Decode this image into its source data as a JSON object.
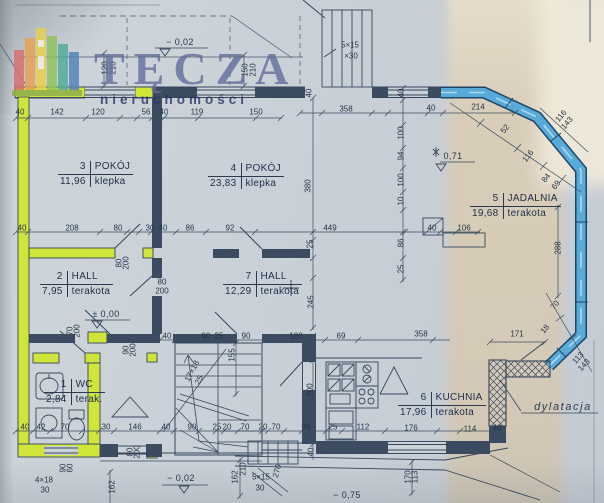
{
  "watermark": {
    "brand": "TĘCZA",
    "subtitle": "nieruchomości"
  },
  "colors": {
    "highlight_green": "#cfe53a",
    "highlight_blue": "#58aad8",
    "line": "#36465c",
    "paper": "#cbd2d8",
    "paper_tan": "#d9cdb7"
  },
  "rooms": [
    {
      "number": "3",
      "name": "POKÓJ",
      "area": "11,96",
      "floor": "klepka"
    },
    {
      "number": "4",
      "name": "POKÓJ",
      "area": "23,83",
      "floor": "klepka"
    },
    {
      "number": "5",
      "name": "JADALNIA",
      "area": "19,68",
      "floor": "terakota"
    },
    {
      "number": "2",
      "name": "HALL",
      "area": "7,95",
      "floor": "terakota"
    },
    {
      "number": "7",
      "name": "HALL",
      "area": "12,29",
      "floor": "terakota"
    },
    {
      "number": "1",
      "name": "WC",
      "area": "2,84",
      "floor": "terak."
    },
    {
      "number": "6",
      "name": "KUCHNIA",
      "area": "17,96",
      "floor": "terakota"
    }
  ],
  "levels": [
    {
      "t": "− 0,02",
      "x": 180,
      "y": 42
    },
    {
      "t": "± 0,00",
      "x": 106,
      "y": 314
    },
    {
      "t": "0,71",
      "x": 453,
      "y": 156
    },
    {
      "t": "− 0,02",
      "x": 181,
      "y": 478
    },
    {
      "t": "− 0,75",
      "x": 347,
      "y": 495
    }
  ],
  "annotations": [
    {
      "t": "5×15",
      "x": 350,
      "y": 45
    },
    {
      "t": "×30",
      "x": 351,
      "y": 56
    },
    {
      "t": "17×18",
      "x": 192,
      "y": 371,
      "r": -62
    },
    {
      "t": "25",
      "x": 199,
      "y": 380,
      "r": -62
    },
    {
      "t": "4×18",
      "x": 44,
      "y": 480
    },
    {
      "t": "30",
      "x": 45,
      "y": 490
    },
    {
      "t": "5×15",
      "x": 261,
      "y": 477
    },
    {
      "t": "30",
      "x": 260,
      "y": 488
    },
    {
      "t": "dylatacja",
      "x": 563,
      "y": 407,
      "cls": "script"
    }
  ],
  "dimensions": [
    {
      "t": "40",
      "x": 20,
      "y": 112
    },
    {
      "t": "142",
      "x": 57,
      "y": 112
    },
    {
      "t": "120",
      "x": 98,
      "y": 112
    },
    {
      "t": "56",
      "x": 146,
      "y": 112
    },
    {
      "t": "40",
      "x": 164,
      "y": 112
    },
    {
      "t": "119",
      "x": 197,
      "y": 112
    },
    {
      "t": "150",
      "x": 256,
      "y": 112
    },
    {
      "t": "358",
      "x": 346,
      "y": 109
    },
    {
      "t": "40",
      "x": 431,
      "y": 108
    },
    {
      "t": "214",
      "x": 478,
      "y": 107
    },
    {
      "t": "120",
      "x": 105,
      "y": 68,
      "r": -90
    },
    {
      "t": "210",
      "x": 113,
      "y": 68,
      "r": -90
    },
    {
      "t": "150",
      "x": 245,
      "y": 70,
      "r": -90
    },
    {
      "t": "210",
      "x": 253,
      "y": 70,
      "r": -90
    },
    {
      "t": "40",
      "x": 309,
      "y": 93,
      "r": -90
    },
    {
      "t": "40",
      "x": 401,
      "y": 93,
      "r": -90
    },
    {
      "t": "100",
      "x": 401,
      "y": 133,
      "r": -90
    },
    {
      "t": "94",
      "x": 401,
      "y": 156,
      "r": -90
    },
    {
      "t": "100",
      "x": 401,
      "y": 180,
      "r": -90
    },
    {
      "t": "380",
      "x": 308,
      "y": 186,
      "r": -90
    },
    {
      "t": "10",
      "x": 401,
      "y": 201,
      "r": -90
    },
    {
      "t": "86",
      "x": 401,
      "y": 243,
      "r": -90
    },
    {
      "t": "25",
      "x": 401,
      "y": 269,
      "r": -90
    },
    {
      "t": "25",
      "x": 310,
      "y": 244,
      "r": -90
    },
    {
      "t": "245",
      "x": 311,
      "y": 302,
      "r": -90
    },
    {
      "t": "288",
      "x": 558,
      "y": 248,
      "r": -90
    },
    {
      "t": "40",
      "x": 22,
      "y": 228
    },
    {
      "t": "208",
      "x": 72,
      "y": 228
    },
    {
      "t": "80",
      "x": 118,
      "y": 228
    },
    {
      "t": "30",
      "x": 150,
      "y": 228
    },
    {
      "t": "40",
      "x": 163,
      "y": 228
    },
    {
      "t": "86",
      "x": 190,
      "y": 228
    },
    {
      "t": "92",
      "x": 230,
      "y": 228
    },
    {
      "t": "449",
      "x": 330,
      "y": 228
    },
    {
      "t": "40",
      "x": 432,
      "y": 228
    },
    {
      "t": "106",
      "x": 464,
      "y": 228
    },
    {
      "t": "80",
      "x": 119,
      "y": 263,
      "r": -90
    },
    {
      "t": "200",
      "x": 126,
      "y": 263,
      "r": -90
    },
    {
      "t": "80",
      "x": 162,
      "y": 282
    },
    {
      "t": "200",
      "x": 162,
      "y": 291
    },
    {
      "t": "70",
      "x": 70,
      "y": 331,
      "r": -90
    },
    {
      "t": "200",
      "x": 77,
      "y": 331,
      "r": -90
    },
    {
      "t": "90",
      "x": 126,
      "y": 350,
      "r": -90
    },
    {
      "t": "200",
      "x": 133,
      "y": 350,
      "r": -90
    },
    {
      "t": "52",
      "x": 505,
      "y": 129,
      "r": -52
    },
    {
      "t": "116",
      "x": 528,
      "y": 156,
      "r": -52
    },
    {
      "t": "84",
      "x": 546,
      "y": 178,
      "r": -52
    },
    {
      "t": "69",
      "x": 556,
      "y": 185,
      "r": -52
    },
    {
      "t": "116",
      "x": 561,
      "y": 116,
      "r": -50
    },
    {
      "t": "143",
      "x": 567,
      "y": 123,
      "r": -50
    },
    {
      "t": "70",
      "x": 555,
      "y": 305,
      "r": -50
    },
    {
      "t": "18",
      "x": 545,
      "y": 329,
      "r": -50
    },
    {
      "t": "113",
      "x": 578,
      "y": 358,
      "r": -48
    },
    {
      "t": "143",
      "x": 584,
      "y": 365,
      "r": -48
    },
    {
      "t": "171",
      "x": 517,
      "y": 334
    },
    {
      "t": "40",
      "x": 167,
      "y": 336
    },
    {
      "t": "90",
      "x": 206,
      "y": 336
    },
    {
      "t": "25",
      "x": 219,
      "y": 336
    },
    {
      "t": "90",
      "x": 246,
      "y": 336
    },
    {
      "t": "180",
      "x": 296,
      "y": 336
    },
    {
      "t": "69",
      "x": 341,
      "y": 336
    },
    {
      "t": "358",
      "x": 421,
      "y": 334
    },
    {
      "t": "155",
      "x": 232,
      "y": 355,
      "r": -90
    },
    {
      "t": "200",
      "x": 310,
      "y": 390,
      "r": -90
    },
    {
      "t": "40",
      "x": 25,
      "y": 427
    },
    {
      "t": "42",
      "x": 41,
      "y": 427
    },
    {
      "t": "70",
      "x": 65,
      "y": 427
    },
    {
      "t": "30",
      "x": 106,
      "y": 427
    },
    {
      "t": "146",
      "x": 135,
      "y": 427
    },
    {
      "t": "40",
      "x": 166,
      "y": 427
    },
    {
      "t": "90",
      "x": 192,
      "y": 427
    },
    {
      "t": "25",
      "x": 217,
      "y": 427
    },
    {
      "t": "20",
      "x": 227,
      "y": 427
    },
    {
      "t": "70",
      "x": 245,
      "y": 427
    },
    {
      "t": "20",
      "x": 263,
      "y": 427
    },
    {
      "t": "70",
      "x": 276,
      "y": 427
    },
    {
      "t": "90",
      "x": 306,
      "y": 427
    },
    {
      "t": "25",
      "x": 333,
      "y": 427
    },
    {
      "t": "112",
      "x": 363,
      "y": 427
    },
    {
      "t": "176",
      "x": 411,
      "y": 428
    },
    {
      "t": "114",
      "x": 470,
      "y": 429
    },
    {
      "t": "40",
      "x": 497,
      "y": 428
    },
    {
      "t": "80",
      "x": 130,
      "y": 452,
      "r": -90
    },
    {
      "t": "200",
      "x": 137,
      "y": 452,
      "r": -90
    },
    {
      "t": "40",
      "x": 311,
      "y": 452,
      "r": -90
    },
    {
      "t": "90",
      "x": 63,
      "y": 468,
      "r": -90
    },
    {
      "t": "60",
      "x": 70,
      "y": 468,
      "r": -90
    },
    {
      "t": "162",
      "x": 112,
      "y": 487,
      "r": -90
    },
    {
      "t": "162",
      "x": 235,
      "y": 477,
      "r": -90
    },
    {
      "t": "210",
      "x": 243,
      "y": 469,
      "r": -90
    },
    {
      "t": "270",
      "x": 277,
      "y": 471,
      "r": -75
    },
    {
      "t": "170",
      "x": 408,
      "y": 477,
      "r": -90
    },
    {
      "t": "113",
      "x": 415,
      "y": 477,
      "r": -90
    }
  ]
}
